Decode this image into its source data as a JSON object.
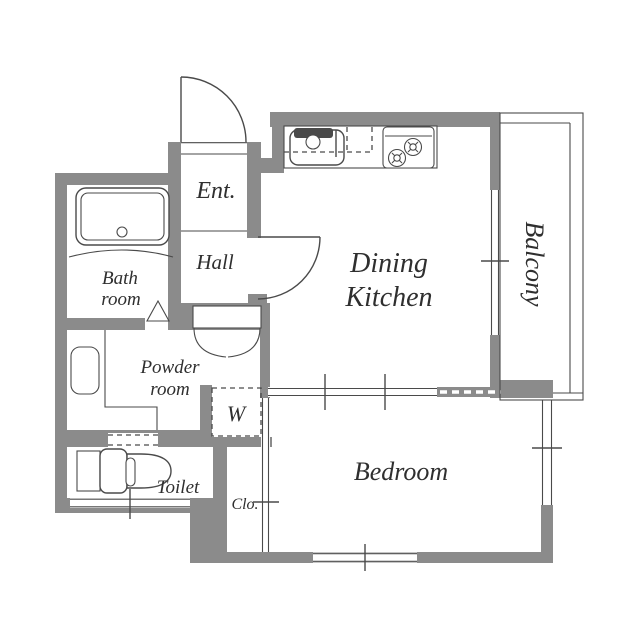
{
  "title": "Apartment floor plan (1DK)",
  "colors": {
    "wall": "#8b8b8b",
    "line": "#4a4a4a",
    "text": "#2f2f2f",
    "bg": "#ffffff"
  },
  "rooms": {
    "entrance": {
      "label": "Ent."
    },
    "hall": {
      "label": "Hall"
    },
    "bathroom": {
      "line1": "Bath",
      "line2": "room"
    },
    "powder_room": {
      "line1": "Powder",
      "line2": "room"
    },
    "toilet": {
      "label": "Toilet"
    },
    "washer_space": {
      "label": "W"
    },
    "closet": {
      "label": "Clo."
    },
    "dining_kitchen": {
      "line1": "Dining",
      "line2": "Kitchen"
    },
    "bedroom": {
      "label": "Bedroom"
    },
    "balcony": {
      "label": "Balcony"
    }
  },
  "fixtures": [
    "bathtub",
    "vanity-sink",
    "kitchen-sink",
    "gas-stove",
    "toilet",
    "washing-machine-space",
    "bifold-door",
    "hinged-doors",
    "sliding-doors",
    "windows"
  ]
}
